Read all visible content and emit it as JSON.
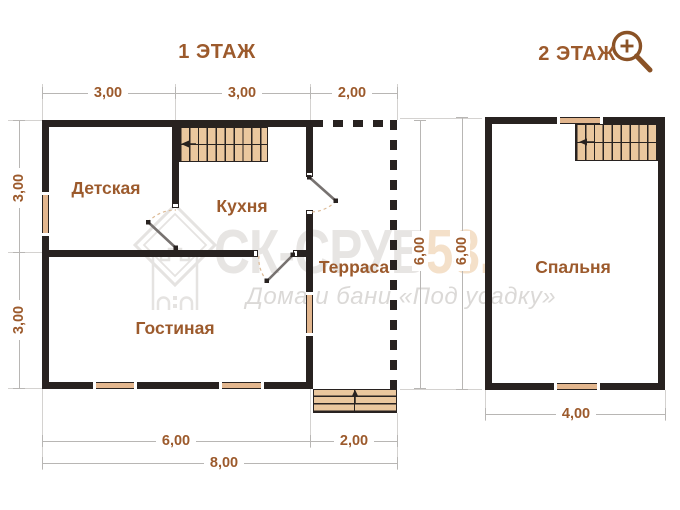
{
  "titles": {
    "floor1": "1 ЭТАЖ",
    "floor2": "2 ЭТАЖ"
  },
  "floor1": {
    "rooms": {
      "kids": "Детская",
      "kitchen": "Кухня",
      "terrace": "Терраса",
      "living": "Гостиная"
    },
    "dims": {
      "top1": "3,00",
      "top2": "3,00",
      "top3": "2,00",
      "left1": "3,00",
      "left2": "3,00",
      "right": "6,00",
      "bottom_main": "6,00",
      "bottom_porch": "2,00",
      "bottom_total": "8,00"
    }
  },
  "floor2": {
    "rooms": {
      "bedroom": "Спальня"
    },
    "dims": {
      "left": "6,00",
      "bottom": "4,00"
    }
  },
  "watermark": {
    "brand": "СК-СРУБ",
    "accent": "53.",
    "tagline": "Дома и бани «Под усадку»"
  },
  "icons": {
    "magnifier": "magnifier-plus-icon",
    "stairs_arrow": "left-arrow",
    "entrance_arrow": "up-arrow"
  },
  "colors": {
    "wall": "#282220",
    "wood": "#e2b68e",
    "stairs": "#eac79e",
    "label": "#9c5a2c",
    "magnifier": "#8a5226",
    "dim_line": "#b8b6b4",
    "watermark_gray": "#e7e5e3",
    "watermark_accent": "#f4e0c9"
  }
}
